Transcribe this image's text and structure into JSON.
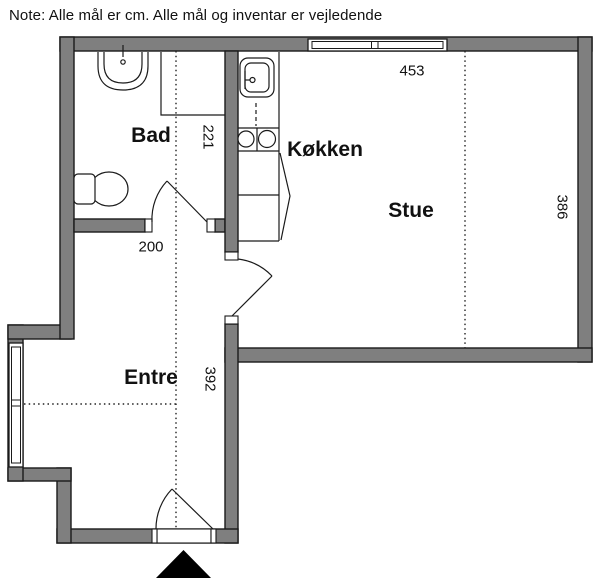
{
  "note": "Note: Alle mål er cm. Alle mål og inventar er vejledende",
  "rooms": {
    "bathroom": {
      "label": "Bad"
    },
    "kitchen": {
      "label": "Køkken"
    },
    "living_room": {
      "label": "Stue"
    },
    "hallway": {
      "label": "Entre"
    }
  },
  "dimensions": {
    "living_room_width": "453",
    "living_room_depth": "386",
    "bathroom_depth": "221",
    "hall_width": "200",
    "hallway_depth": "392"
  },
  "fixtures": {
    "bathroom_sink": "bathroom-sink",
    "toilet": "toilet",
    "shower": "shower-enclosure",
    "kitchen_sink": "kitchen-sink",
    "cooktop": "cooktop-two-burners",
    "cabinets": "kitchen-cabinets",
    "top_window": "window",
    "left_window": "window",
    "entrance_marker": "entrance-arrow"
  },
  "colors": {
    "wall_fill": "#7f7f7f",
    "outline": "#1a1a1a",
    "background": "#ffffff",
    "entrance_marker": "#000000"
  }
}
